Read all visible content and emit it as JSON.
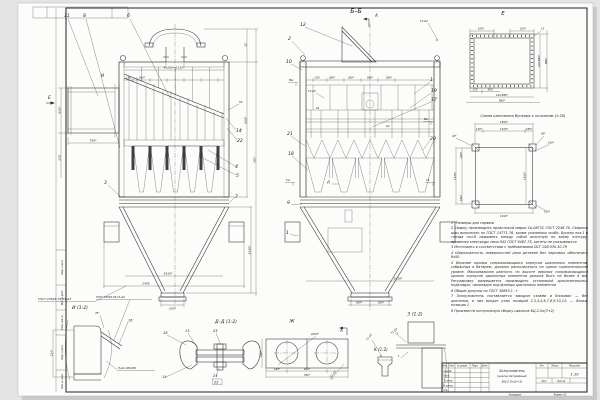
{
  "frame": {
    "margin_labels": [
      "Подп. и дата",
      "Инв. № дубл.",
      "Взам. инв. №",
      "Подп. и дата",
      "Инв. № подл."
    ]
  },
  "main_view": {
    "marker_i": "И",
    "view_arrow_e": "Е",
    "weld_gost": "ГОСТ 23518-79-Т1-Δ3",
    "weld_k3": "К3",
    "callouts": {
      "c11": "11",
      "c8": "8",
      "c6": "6",
      "c14": "14",
      "c22": "22",
      "c4": "4",
      "c5": "5",
      "c3": "3",
      "c7": "7"
    },
    "dims": {
      "top": "4х280=1120*",
      "d150": "150",
      "d280": "280*",
      "d750": "750*",
      "d650": "650*",
      "d150b": "150",
      "d52": "52",
      "d628": "628*",
      "d787": "787",
      "d1610": "1610*",
      "d2405": "2405",
      "d200": "200*",
      "d1430": "1430*"
    }
  },
  "section_view": {
    "title": "Б–Б",
    "cut_a": "А",
    "cut_d": "Д",
    "weld_t1d4": "Т1-Δ4",
    "weld_t1d3": "Т1-Δ3",
    "marker_k1": "К1",
    "marker_k2": "К2",
    "flags": {
      "vm": "Вм",
      "vv": "Вв",
      "gm": "Гм",
      "gv": "Гв"
    },
    "dims": {
      "d150": "150",
      "d280a": "280*",
      "d280b": "280*",
      "d280c": "280*",
      "d280d": "280*",
      "d300a": "300*",
      "d300b": "300*",
      "d1610": "1610*"
    },
    "callouts": {
      "c12": "12",
      "c2": "2",
      "c10": "10",
      "c1": "1",
      "c19": "19",
      "c17": "17",
      "c21": "21",
      "c18": "18",
      "c20": "20",
      "c9": "9",
      "c1b": "1"
    }
  },
  "view_e": {
    "title": "Е",
    "dims": {
      "top_l": "100*",
      "top_r": "100*",
      "c12": "12",
      "right_a": "470-880*",
      "right_b": "888*",
      "b125": "125",
      "b300": "300",
      "b410": "410-880*",
      "b980": "980*"
    }
  },
  "mount_scheme": {
    "title": "Схема крепления бункера к колоннам (1:20)",
    "dims": {
      "d1850": "1850*",
      "d1320": "1320*",
      "d140": "140*",
      "d180t": "180*",
      "d40l": "40*",
      "d40r": "40*",
      "d100": "100*",
      "d160": "160*",
      "d1570": "1570*",
      "d180b": "180*",
      "d1610b": "1610*",
      "d130": "130*",
      "d1610r": "1610*"
    }
  },
  "notes": [
    "1 *Размеры для справок",
    "2 Сварку производить проволокой марки Св-08Г2С ГОСТ 2246-70. Сварные швы выполнять по ГОСТ 14771-76, кроме указанных особо. Бункер поз.1 и гнезда поз.8 сваривать между собой вплотную по всему контуру, применяя электроды типа Э42 ГОСТ 9467-75, катеты не указываются",
    "3 Изготовить в соответствии с требованиями ОСТ 108.030.30-79",
    "4 Шероховатость поверхностей реза деталей без черновых обеспечить Rz50",
    "5 Верхние кромки соприкасающихся корпусов циклонных элементов, собранных в батарею, должны располагаться на одном горизонтальном уровне. Максимальная разность по высоте верхних соприкасающихся кромок корпусов циклонных элементов должна быть не более 8 мм. Регулировку разрешается производить установкой дополнительных подкладок, прокладок под фланцы циклонных элементов",
    "6 Общие допуски по ГОСТ 30893.1 - t",
    "7 Золоуловитель поставляется заводом узлами и блоками: — без циклонов, в них входят узлы позиций 2,3,4,5,6,7,8,9,10,11; — блоки, позиция 1",
    "8 Произвести контрольную сборку циклона БЦ-2-5х(3+2)"
  ],
  "details": {
    "i": {
      "title": "И (1:2)",
      "gost": "ГОСТ 23518-79-Т1-Δ3",
      "angle": "45°",
      "c16": "16",
      "weld": "Н-Δ3-100/200",
      "d124": "124*"
    },
    "dd": {
      "title": "Д–Д (1:2)",
      "c18": "18",
      "c13": "13",
      "c23": "23",
      "c14": "14",
      "c24": "24",
      "c25": "25"
    },
    "j": {
      "title": "Ж",
      "d300": "ø300*",
      "d180l": "180*",
      "d180": "180*",
      "d400": "400*",
      "d760": "760*"
    },
    "k": {
      "title": "К (1:2)",
      "view_a": "А",
      "weld": "Т1-Δ3",
      "weld2": "Т1-Δ3"
    },
    "z": {
      "title": "З (1:2)",
      "weld": "Т1-Δ3",
      "t": "t"
    }
  },
  "title_block": {
    "name_line1": "Золоуловитель",
    "name_line2": "(циклон батарейный)",
    "name_line3": "БЦ-2-5х(3+2)",
    "scale": "1:10",
    "col_izm": "Изм.",
    "col_list": "Лист",
    "col_doc": "№ докум.",
    "col_podp": "Подп.",
    "col_data": "Дата",
    "rows": [
      "Разраб.",
      "Пров.",
      "Т.контр.",
      "Н.контр.",
      "Утв."
    ],
    "lit": "Лит.",
    "massa": "Масса",
    "masshtab": "Масштаб",
    "list": "Лист",
    "listov": "Листов",
    "kopiroval": "Копировал",
    "format": "Формат А1"
  }
}
